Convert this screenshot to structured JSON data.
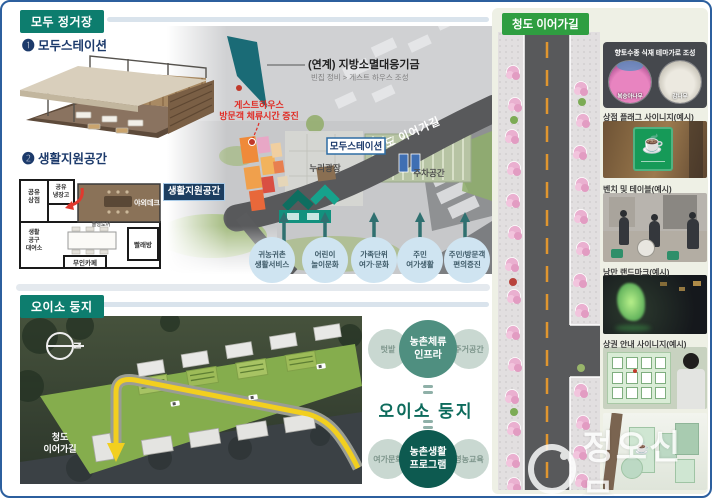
{
  "colors": {
    "header_teal": "#0d7d6e",
    "panel_green": "#2f9e41",
    "accent_red": "#e02d26",
    "navy": "#1c3a6b",
    "effect_circle_blue": "#cfe4f1",
    "diagram_teal": "#4f8f80",
    "diagram_dark_teal": "#0d5a50",
    "road_gray": "#58595b",
    "path_yellow": "#f2cf1f",
    "border_blue": "#2c5f9e"
  },
  "icons": {
    "coffee_cup": "☕",
    "copyright_mark": "Ⓒ",
    "north": "N",
    "bullet_one": "❶",
    "bullet_two": "❷"
  },
  "watermark": {
    "text": "정오신문"
  },
  "modu": {
    "header": "모두 정거장",
    "item1_num": "❶",
    "item1_label": "모두스테이션",
    "item2_num": "❷",
    "item2_label": "생활지원공간",
    "floorplan": {
      "fridge_l1": "공유",
      "fridge_l2": "냉장고",
      "shop_l1": "공유",
      "shop_l2": "상점",
      "deck": "야외데크",
      "door": "폴딩도어",
      "tool_l1": "생활",
      "tool_l2": "공구",
      "tool_l3": "대여소",
      "cafe": "무인카페",
      "laundry": "빨래방"
    }
  },
  "siteplan": {
    "fund_title": "(연계) 지방소멸대응기금",
    "fund_sub": "빈집 정비 > 게스트 하우스 조성",
    "gh_l1": "게스트하우스",
    "gh_l2": "방문객 체류시간 증진",
    "road_label": "청도 이어가길",
    "station_box": "모두스테이션",
    "support_box": "생활지원공간",
    "plaza": "누리광장",
    "parking": "주차공간",
    "effects": [
      {
        "l1": "귀농귀촌",
        "l2": "생활서비스"
      },
      {
        "l1": "어린이",
        "l2": "놀이문화"
      },
      {
        "l1": "가족단위",
        "l2": "여가·문화"
      },
      {
        "l1": "주민",
        "l2": "여가생활"
      },
      {
        "l1": "주민/방문객",
        "l2": "편의증진"
      }
    ]
  },
  "oiso": {
    "header": "오이소 둥지",
    "compass": "N",
    "road_l1": "청도",
    "road_l2": "이어가길",
    "diagram": {
      "top_l1": "농촌체류",
      "top_l2": "인프라",
      "top_left": "텃밭",
      "top_right": "주거공간",
      "center": "오이소 둥지",
      "bottom_l1": "농촌생활",
      "bottom_l2": "프로그램",
      "bottom_left": "여가문화",
      "bottom_right": "영농교육"
    }
  },
  "panel": {
    "header": "청도 이어가길",
    "theme_title": "향토수종 식재 테마가로 조성",
    "tree1": "복숭아나무",
    "tree2": "감나무",
    "rows": [
      {
        "label": "상점 플래그 사이니지(예시)"
      },
      {
        "label": "벤치 및 테이블(예시)"
      },
      {
        "label": "낭만 랜드마크(예시)"
      },
      {
        "label": "상권 안내 사이니지(예시)"
      }
    ]
  }
}
